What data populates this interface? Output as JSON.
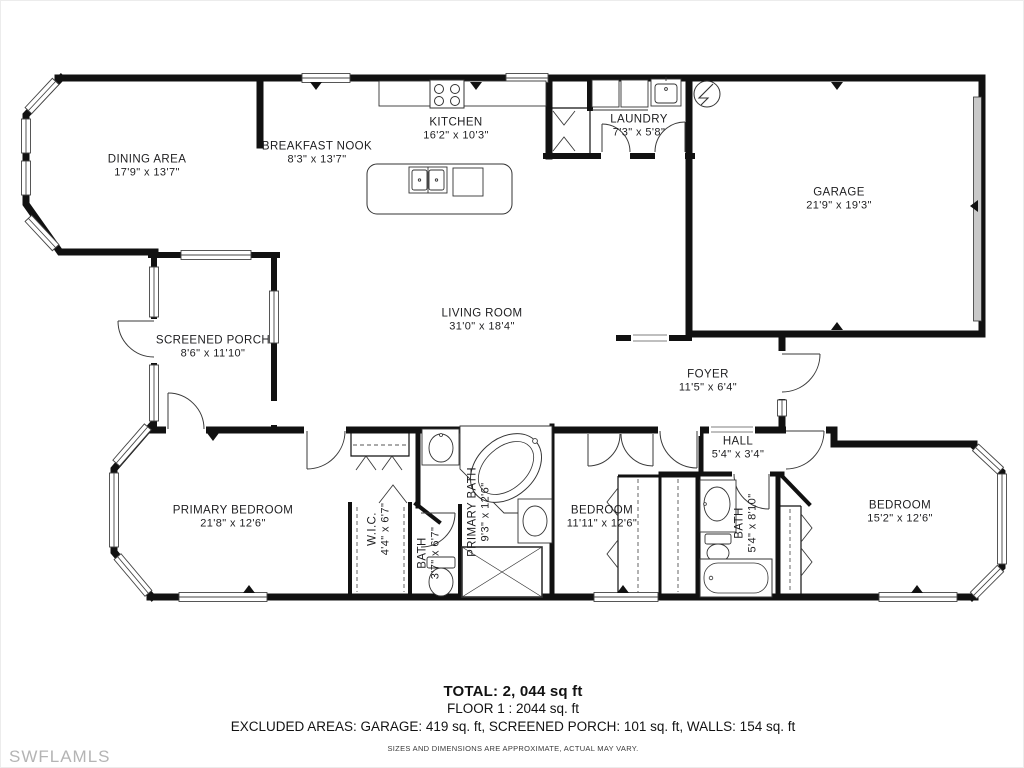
{
  "watermark": "SWFLAMLS",
  "colors": {
    "wall": "#111111",
    "fixture": "#333333",
    "garage_door": "#c9c9c9",
    "watermark": "#b4b4b4"
  },
  "rooms": [
    {
      "id": "dining",
      "name": "DINING AREA",
      "dims": "17'9\" x 13'7\""
    },
    {
      "id": "breakfast-nook",
      "name": "BREAKFAST NOOK",
      "dims": "8'3\" x 13'7\""
    },
    {
      "id": "kitchen",
      "name": "KITCHEN",
      "dims": "16'2\" x 10'3\""
    },
    {
      "id": "laundry",
      "name": "LAUNDRY",
      "dims": "7'3\" x 5'8\""
    },
    {
      "id": "garage",
      "name": "GARAGE",
      "dims": "21'9\" x 19'3\""
    },
    {
      "id": "living-room",
      "name": "LIVING ROOM",
      "dims": "31'0\" x 18'4\""
    },
    {
      "id": "screened-porch",
      "name": "SCREENED PORCH",
      "dims": "8'6\" x 11'10\""
    },
    {
      "id": "foyer",
      "name": "FOYER",
      "dims": "11'5\" x 6'4\""
    },
    {
      "id": "hall",
      "name": "HALL",
      "dims": "5'4\" x 3'4\""
    },
    {
      "id": "primary-bedroom",
      "name": "PRIMARY BEDROOM",
      "dims": "21'8\" x 12'6\""
    },
    {
      "id": "wic",
      "name": "W.I.C.",
      "dims": "4'4\" x 6'7\""
    },
    {
      "id": "bath-2",
      "name": "BATH",
      "dims": "3'7\" x 6'7\""
    },
    {
      "id": "primary-bath",
      "name": "PRIMARY BATH",
      "dims": "9'3\" x 12'6\""
    },
    {
      "id": "bedroom-2",
      "name": "BEDROOM",
      "dims": "11'11\" x 12'6\""
    },
    {
      "id": "hall-bath",
      "name": "BATH",
      "dims": "5'4\" x 8'10\""
    },
    {
      "id": "bedroom-3",
      "name": "BEDROOM",
      "dims": "15'2\" x 12'6\""
    }
  ],
  "summary": {
    "total": "TOTAL:  2, 044 sq ft",
    "floor": "FLOOR 1 : 2044  sq. ft",
    "excluded": "EXCLUDED AREAS: GARAGE: 419 sq. ft, SCREENED PORCH: 101 sq. ft, WALLS: 154 sq. ft",
    "disclaimer": "SIZES AND DIMENSIONS ARE APPROXIMATE, ACTUAL MAY VARY."
  }
}
